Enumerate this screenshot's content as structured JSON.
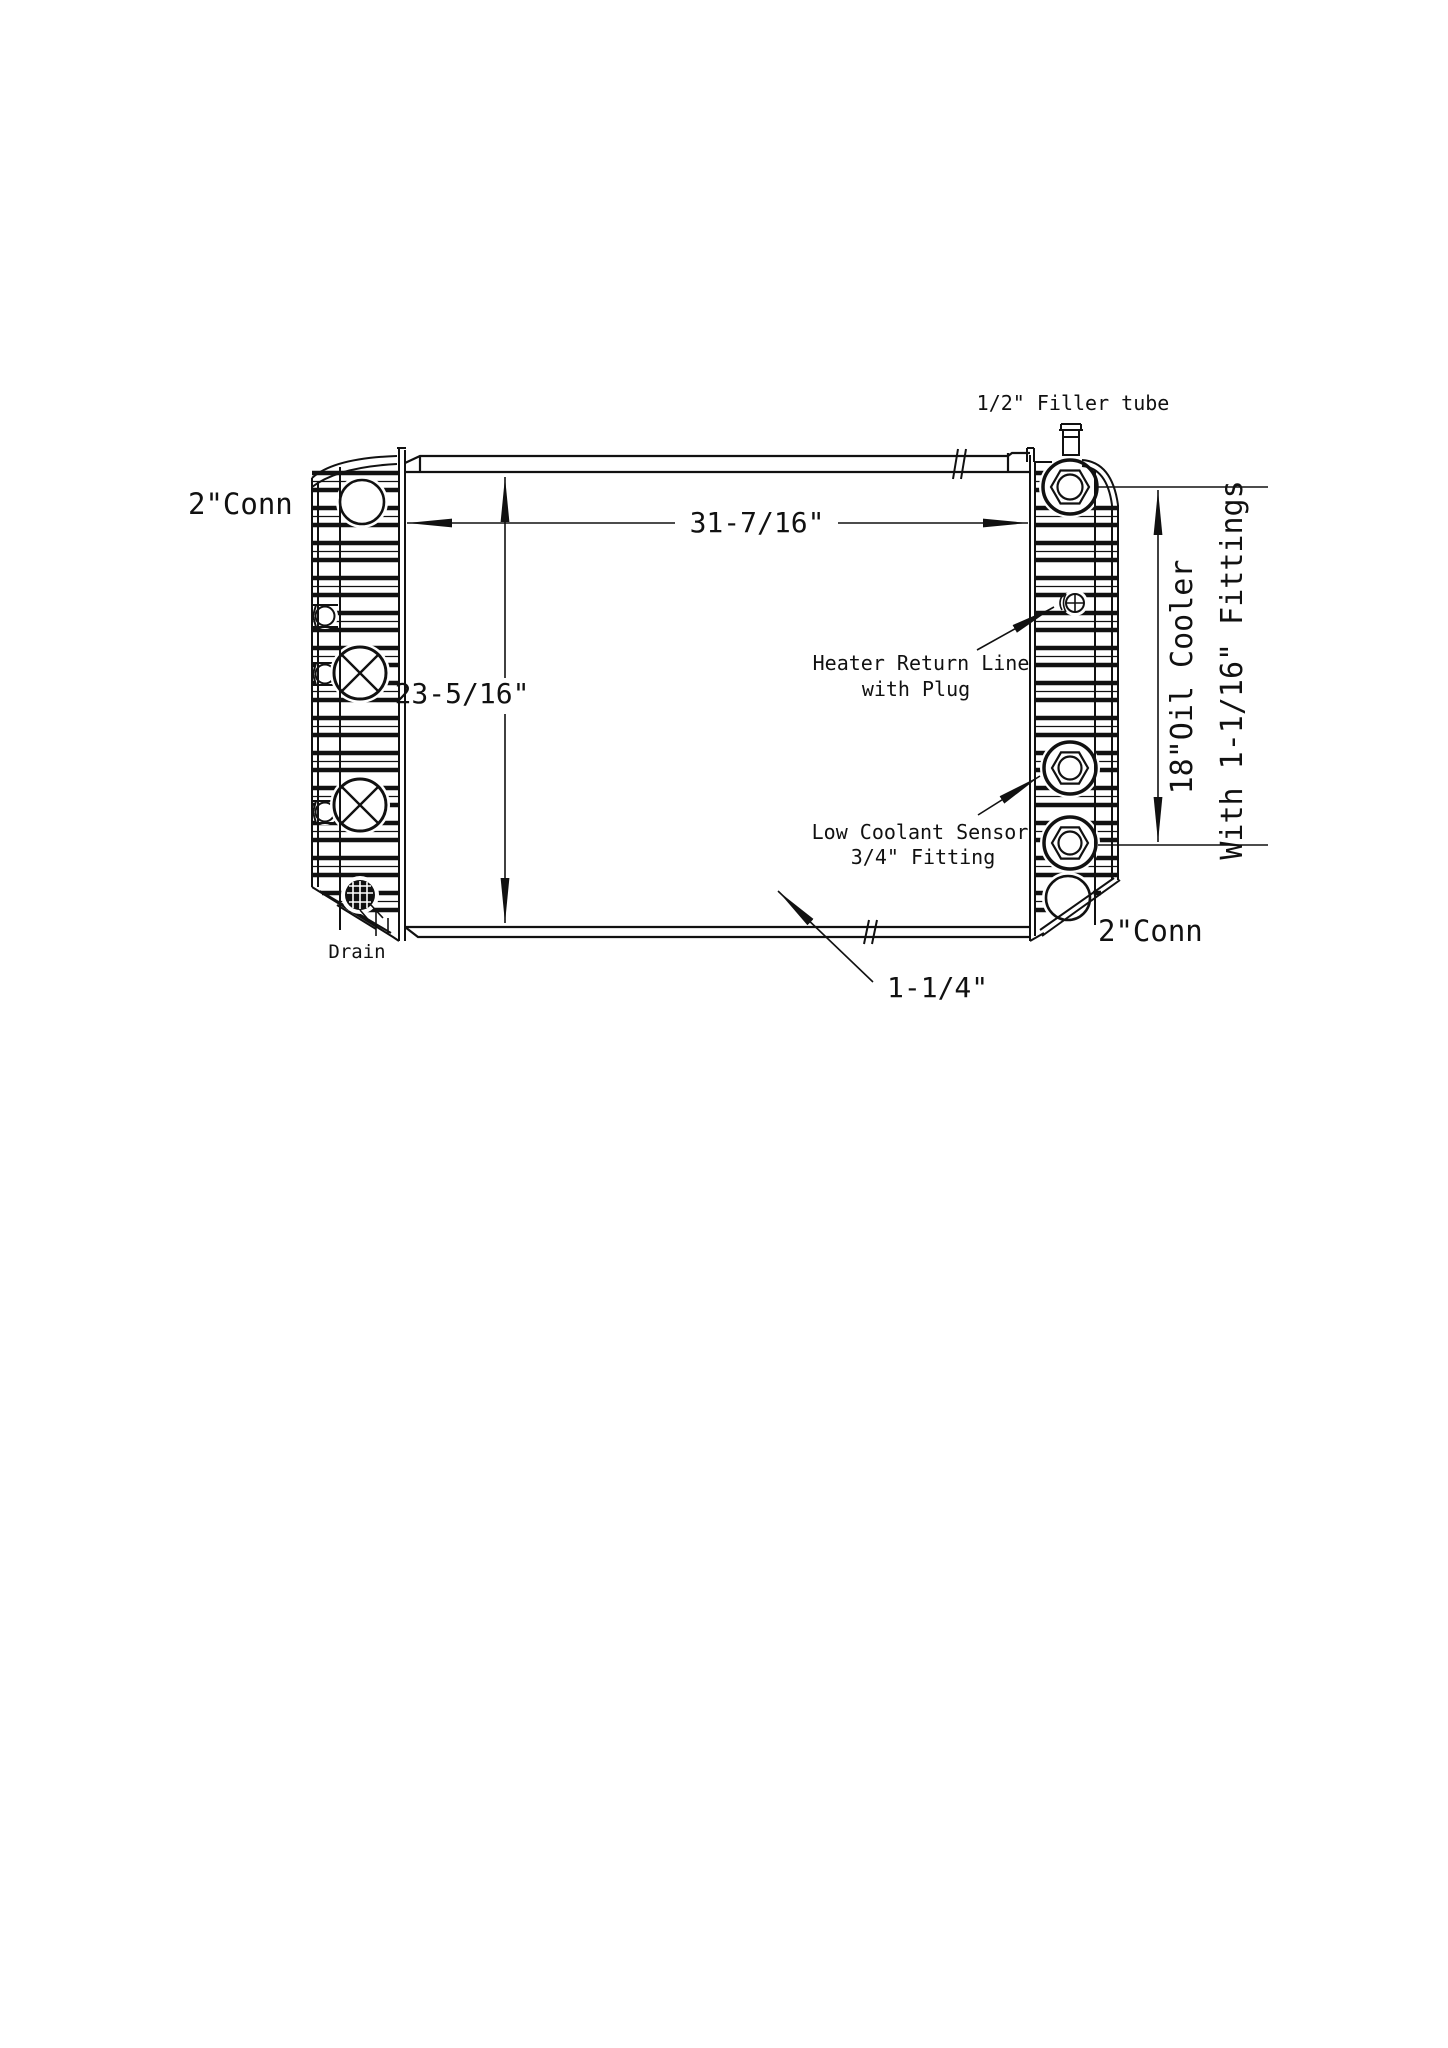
{
  "diagram": {
    "kind": "radiator-technical-line-drawing",
    "colors": {
      "ink": "#111111",
      "background": "#ffffff"
    },
    "labels": {
      "filler_tube": "1/2\" Filler tube",
      "conn_top_left": "2\"Conn",
      "conn_bottom_right": "2\"Conn",
      "heater_return_line1": "Heater Return Line",
      "heater_return_line2": "with Plug",
      "low_coolant_line1": "Low Coolant Sensor",
      "low_coolant_line2": "3/4\" Fitting",
      "drain": "Drain",
      "oil_cooler_vertical": "18\"Oil Cooler",
      "fittings_vertical": "With 1-1/16\" Fittings"
    },
    "dimensions": {
      "core_width": "31-7/16\"",
      "core_height": "23-5/16\"",
      "outlet_size": "1-1/4\""
    }
  }
}
